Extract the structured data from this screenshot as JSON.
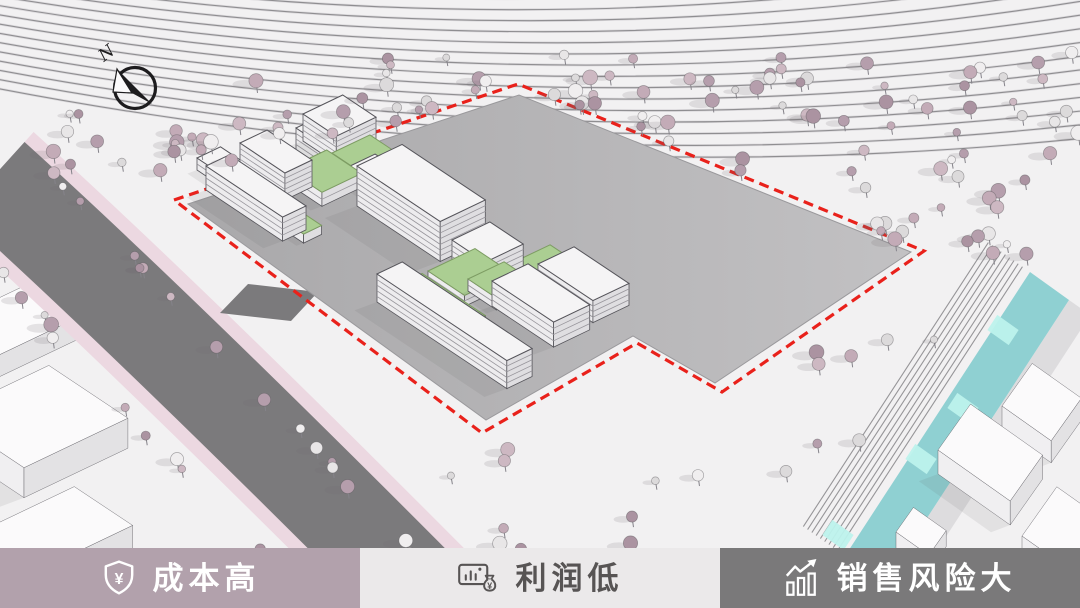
{
  "meta": {
    "width": 1080,
    "height": 608
  },
  "labels": {
    "order": [
      "cost",
      "profit",
      "risk"
    ],
    "cost": {
      "text": "成本高",
      "bg": "#b2a1ac",
      "fg": "#ffffff",
      "icon": "shield-yen-icon",
      "icon_char": "¥"
    },
    "profit": {
      "text": "利润低",
      "bg": "#ebe9ea",
      "fg": "#575454",
      "icon": "moneybag-chart-icon",
      "icon_char": "¥"
    },
    "risk": {
      "text": "销售风险大",
      "bg": "#7a797a",
      "fg": "#ffffff",
      "icon": "rising-bars-icon"
    }
  },
  "compass": {
    "cx": 135,
    "cy": 88,
    "r": 20.5,
    "label": "N",
    "color": "#1d1c1e"
  },
  "scene": {
    "ground": "#f2f1f2",
    "contours": {
      "count": 16,
      "x0": -15,
      "x1": 1095,
      "cx": 545,
      "left": [
        -52,
        9.2
      ],
      "ctrl": [
        36,
        10.6
      ],
      "right": [
        -70,
        13.8
      ],
      "dark": "#8f8e91",
      "light": "#dbd9dc"
    },
    "road": {
      "pts": [
        [
          -8,
          178
        ],
        [
          160,
          330
        ],
        [
          438,
          610
        ]
      ],
      "pink": "#ecd8e1",
      "dark": "#7b7a7c",
      "w_pink": 124,
      "w_dark": 97,
      "stub": [
        [
          220,
          313
        ],
        [
          248,
          284
        ],
        [
          318,
          292
        ],
        [
          291,
          321
        ]
      ]
    },
    "parcel": {
      "boundary": [
        [
          174,
          200
        ],
        [
          518,
          84
        ],
        [
          924,
          251
        ],
        [
          722,
          392
        ],
        [
          637,
          343
        ],
        [
          482,
          433
        ]
      ],
      "pad": [
        [
          188,
          204
        ],
        [
          519,
          95
        ],
        [
          911,
          252
        ],
        [
          715,
          383
        ],
        [
          633,
          336
        ],
        [
          486,
          420
        ]
      ],
      "pad_fill_from": "#a9a8aa",
      "pad_fill_to": "#c2c1c3",
      "edge": "#9a999c",
      "boundary_color": "#e9211b"
    },
    "channel": {
      "left_top": [
        1030,
        272
      ],
      "left_bot": [
        845,
        556
      ],
      "width_vec": [
        39,
        28
      ],
      "fill": "#8fd0d2",
      "lights": [
        [
          1003,
          330
        ],
        [
          963,
          408
        ],
        [
          921,
          459
        ],
        [
          838,
          535
        ]
      ],
      "light_fill": "#bdf2ec",
      "emb_count": 9,
      "emb_step": 5.2,
      "emb_color": "#8d8c8f",
      "slope_fill": "#d4d3d5"
    },
    "axes": {
      "u": [
        0.832,
        0.555
      ],
      "v": [
        0.903,
        -0.431
      ],
      "u2": [
        0.82,
        0.58
      ],
      "v2": [
        0.58,
        -0.82
      ]
    },
    "building_colors": {
      "top": "#f5f4f5",
      "green": "#abce92",
      "sw": "#edecee",
      "se": "#dfdee1",
      "line": "#97959b",
      "outline": "#55545a",
      "ctx_top": "#fbfafb",
      "ctx_sw": "#f0eff1",
      "ctx_se": "#e3e2e4"
    },
    "buildings": [
      [
        197,
        170,
        30,
        26,
        12,
        2,
        "w"
      ],
      [
        206,
        190,
        92,
        26,
        24,
        4,
        "w"
      ],
      [
        242,
        202,
        74,
        20,
        9,
        1,
        "g"
      ],
      [
        240,
        170,
        54,
        30,
        27,
        5,
        "w"
      ],
      [
        287,
        183,
        42,
        44,
        14,
        2,
        "g"
      ],
      [
        296,
        150,
        30,
        34,
        22,
        4,
        "w"
      ],
      [
        303,
        141,
        40,
        44,
        27,
        5,
        "w"
      ],
      [
        332,
        166,
        38,
        42,
        13,
        2,
        "g"
      ],
      [
        348,
        180,
        28,
        30,
        13,
        2,
        "w"
      ],
      [
        357,
        206,
        100,
        50,
        40,
        7,
        "w"
      ],
      [
        437,
        237,
        28,
        30,
        10,
        1,
        "g"
      ],
      [
        452,
        262,
        40,
        42,
        22,
        4,
        "w"
      ],
      [
        428,
        282,
        44,
        52,
        11,
        2,
        "g"
      ],
      [
        404,
        297,
        76,
        20,
        15,
        3,
        "g"
      ],
      [
        514,
        272,
        32,
        40,
        10,
        2,
        "g"
      ],
      [
        538,
        286,
        66,
        40,
        22,
        4,
        "w"
      ],
      [
        468,
        291,
        34,
        40,
        12,
        2,
        "g"
      ],
      [
        492,
        306,
        74,
        40,
        25,
        4,
        "w"
      ],
      [
        377,
        302,
        156,
        28,
        28,
        5,
        "w"
      ]
    ],
    "context": [
      [
        -60,
        348,
        60,
        95,
        22,
        1,
        "c"
      ],
      [
        -55,
        445,
        95,
        115,
        30,
        1,
        "c"
      ],
      [
        -25,
        560,
        70,
        110,
        26,
        1,
        "c"
      ]
    ],
    "context2": [
      [
        1002,
        428,
        60,
        52,
        22,
        1,
        "c"
      ],
      [
        938,
        474,
        88,
        56,
        24,
        1,
        "c"
      ],
      [
        1022,
        560,
        80,
        60,
        24,
        1,
        "c"
      ],
      [
        896,
        548,
        40,
        30,
        16,
        1,
        "c"
      ]
    ],
    "trees": {
      "palette_dark": [
        "#c3abb7",
        "#b59eac",
        "#cdb8c2",
        "#ab93a1"
      ],
      "palette_light": [
        "#e8e6e7",
        "#dcdadb",
        "#f0eeef"
      ],
      "stem": "#85838a",
      "bands": [
        {
          "t": "r",
          "r": [
            380,
            52,
            700,
            70
          ],
          "n": 60,
          "s": 1
        },
        {
          "t": "r",
          "r": [
            840,
            125,
            240,
            130
          ],
          "n": 26,
          "s": 2
        },
        {
          "t": "r",
          "r": [
            155,
            80,
            330,
            105
          ],
          "n": 34,
          "s": 3
        },
        {
          "t": "l",
          "a": [
            545,
            100
          ],
          "b": [
            905,
            248
          ],
          "n": 13,
          "s": 4,
          "perp": [
            0.37,
            -0.93
          ],
          "off": [
            4,
            24
          ]
        },
        {
          "t": "r",
          "r": [
            300,
            432,
            440,
            120
          ],
          "n": 16,
          "s": 5,
          "road": true
        },
        {
          "t": "r",
          "r": [
            760,
            290,
            215,
            185
          ],
          "n": 15,
          "s": 6,
          "chan": true
        },
        {
          "t": "l",
          "a": [
            30,
            148
          ],
          "b": [
            432,
            568
          ],
          "n": 17,
          "s": 7,
          "perp": [
            0,
            0
          ],
          "off": [
            -4,
            8
          ]
        },
        {
          "t": "l",
          "a": [
            -15,
            258
          ],
          "b": [
            298,
            598
          ],
          "n": 12,
          "s": 8,
          "perp": [
            0,
            0
          ],
          "off": [
            -4,
            8
          ]
        },
        {
          "t": "r",
          "r": [
            25,
            108,
            150,
            58
          ],
          "n": 7,
          "s": 9
        }
      ]
    }
  }
}
